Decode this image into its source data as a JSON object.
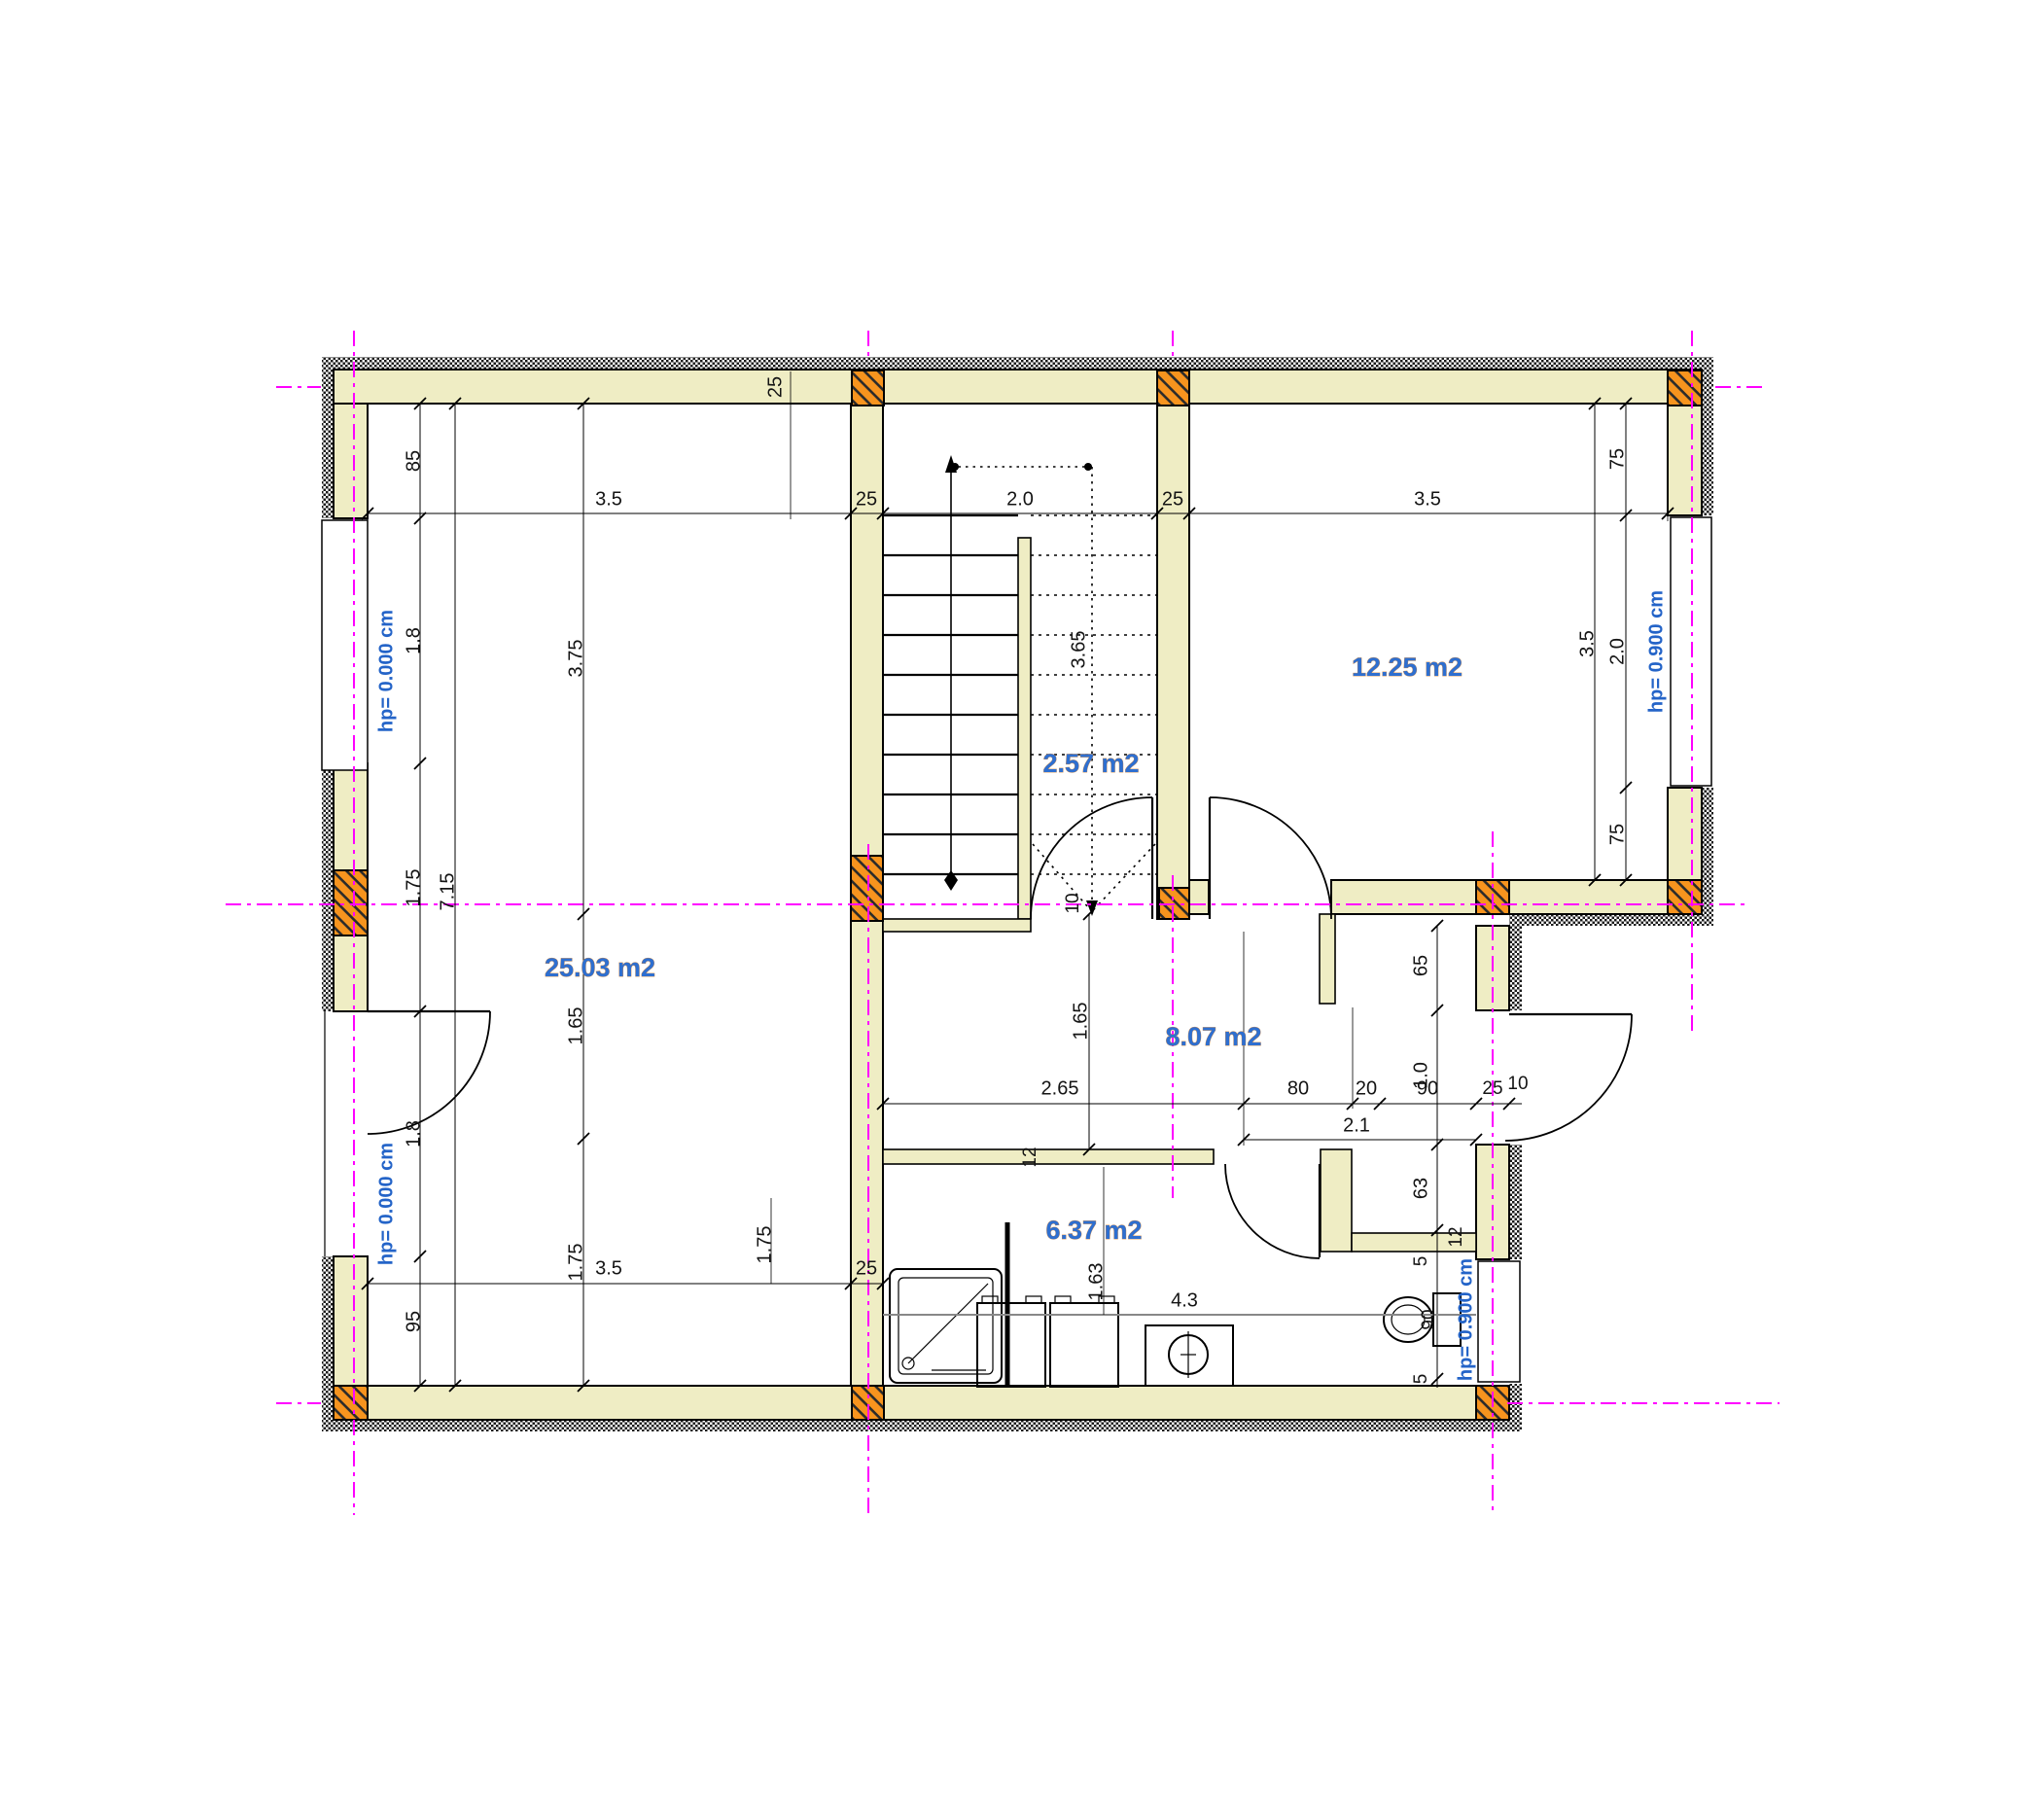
{
  "plan": {
    "rooms": {
      "living": "25.03 m2",
      "staircase": "2.57 m2",
      "bedroom": "12.25 m2",
      "hall": "8.07 m2",
      "bathroom": "6.37 m2"
    },
    "levels": {
      "floor_zero": "hp= 0.000 cm",
      "sill_90": "hp= 0.900 cm"
    },
    "dims": {
      "top_row": [
        "3.5",
        "25",
        "2.0",
        "25",
        "3.5"
      ],
      "top_wall": "25",
      "left_chain": [
        "85",
        "1.8",
        "1.75",
        "1.8",
        "95"
      ],
      "left_total": "7.15",
      "left_inner": [
        "3.75",
        "1.65",
        "1.75"
      ],
      "stair_run": "3.65",
      "hall_left": "1.65",
      "thin_wall_10": "10",
      "thin_wall_12": "12",
      "hall_row": [
        "2.65",
        "80",
        "20",
        "90",
        "25",
        "10"
      ],
      "hall_total": "2.1",
      "right_chain": [
        "65",
        "1.0",
        "63",
        "5",
        "5"
      ],
      "jog_wall_12": "12",
      "toilet_width": "90",
      "bottom_row": [
        "3.5",
        "1.75",
        "25"
      ],
      "bath_row": [
        "1.63",
        "4.3"
      ],
      "bedroom_window": [
        "75",
        "2.0",
        "75"
      ],
      "bedroom_height": "3.5"
    }
  }
}
